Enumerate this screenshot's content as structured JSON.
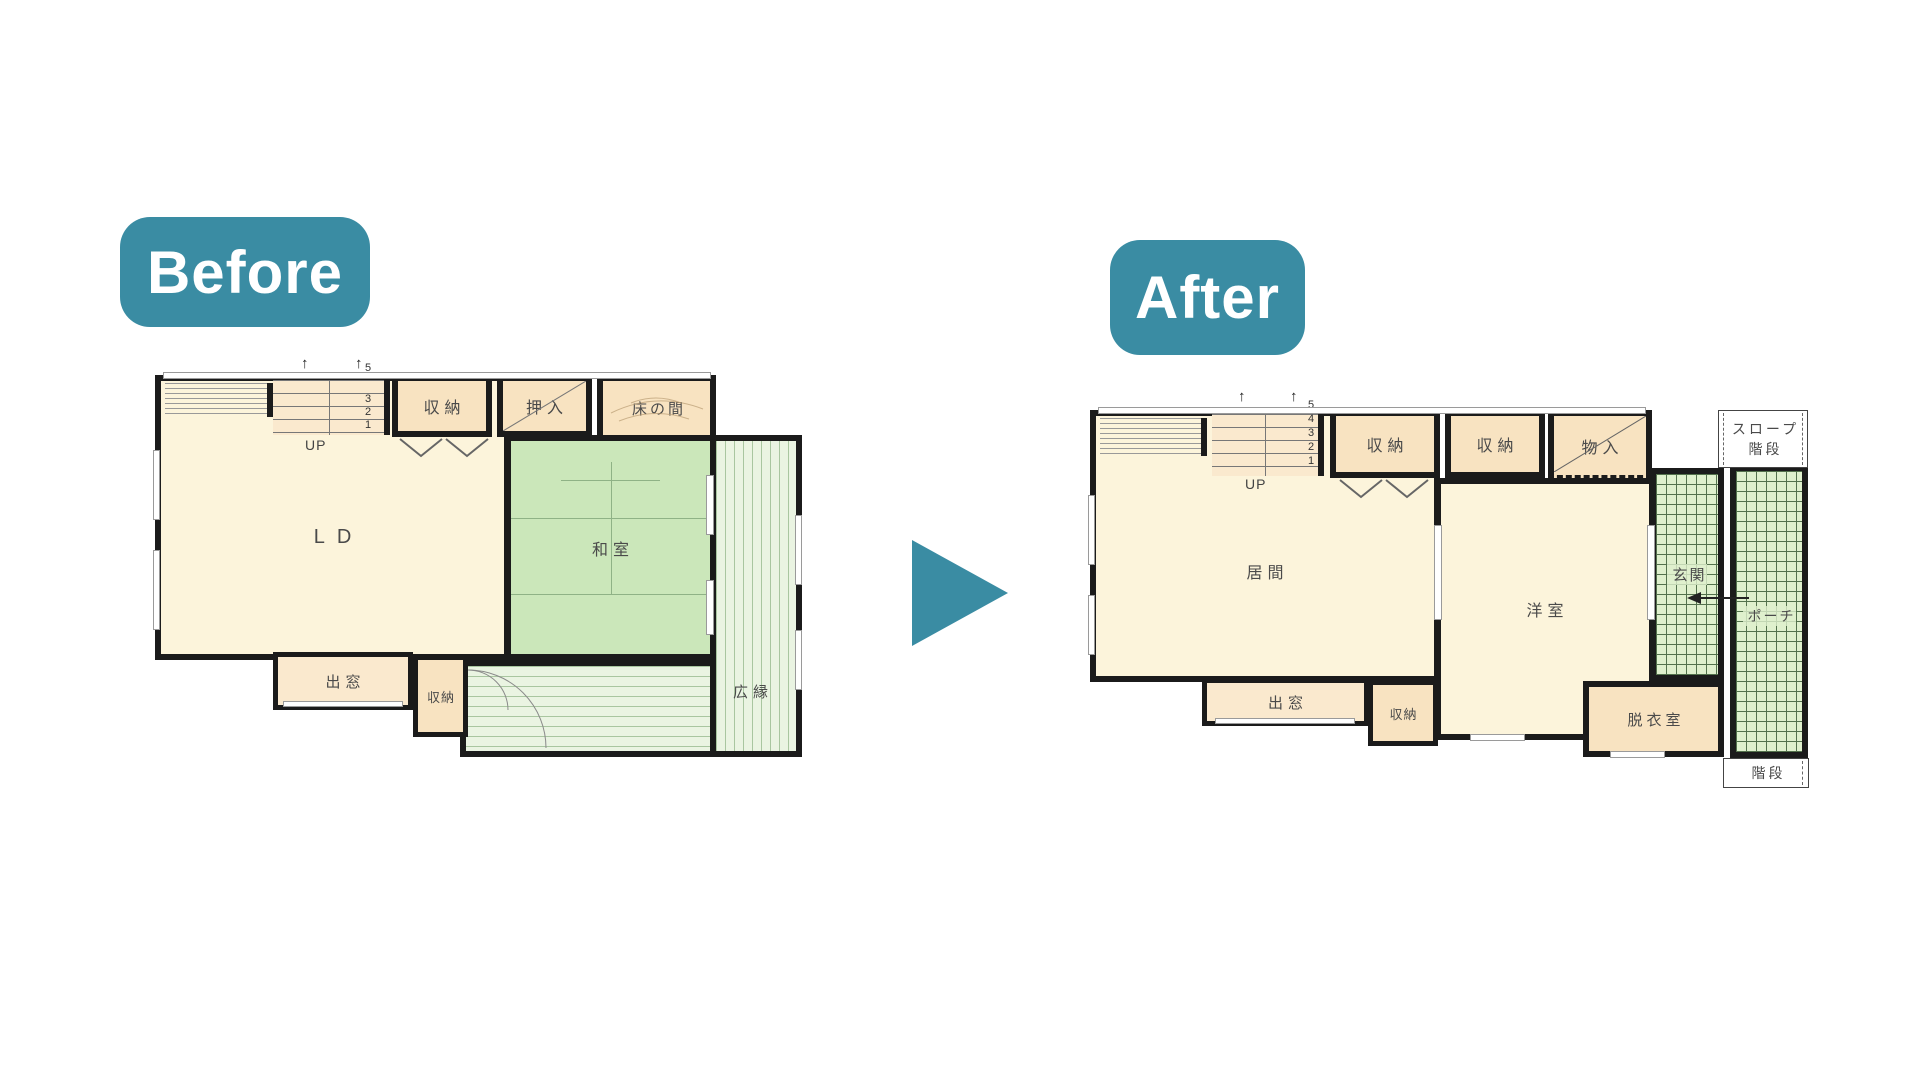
{
  "badges": {
    "before": "Before",
    "after": "After"
  },
  "icons": {
    "up_arrow": "↑"
  },
  "colors": {
    "teal": "#3A8CA3",
    "cream": "#FCF4DB",
    "tan": "#F8E3C1",
    "tan-light": "#FAE9CE",
    "tatami": "#CBE7BA",
    "tatami-line": "#8FB286",
    "veranda": "#EAF4E2",
    "veranda-line": "#A9C6A0",
    "tile": "#DFF0CD",
    "tile-line": "#53714C",
    "wall": "#1B1B1B",
    "text": "#4A4A4A"
  },
  "before_plan": {
    "stairs": {
      "up_label": "UP",
      "numbers": [
        "5",
        "3",
        "2",
        "1"
      ]
    },
    "rooms": {
      "ld": "LD",
      "washitsu": "和室",
      "shunou_top": "収納",
      "oshiire": "押入",
      "tokonoma": "床の間",
      "demado": "出窓",
      "shunou_small": "収納",
      "hiroen": "広縁"
    }
  },
  "after_plan": {
    "stairs": {
      "up_label": "UP",
      "numbers": [
        "5",
        "4",
        "3",
        "2",
        "1"
      ]
    },
    "rooms": {
      "ima": "居間",
      "youshitsu": "洋室",
      "shunou_1": "収納",
      "shunou_2": "収納",
      "monoire": "物入",
      "genkan": "玄関",
      "porch": "ポーチ",
      "datsuishitsu": "脱衣室",
      "demado": "出窓",
      "shunou_small": "収納",
      "slope": "スロープ",
      "slope_kaidan": "階段",
      "kaidan": "階段"
    }
  }
}
